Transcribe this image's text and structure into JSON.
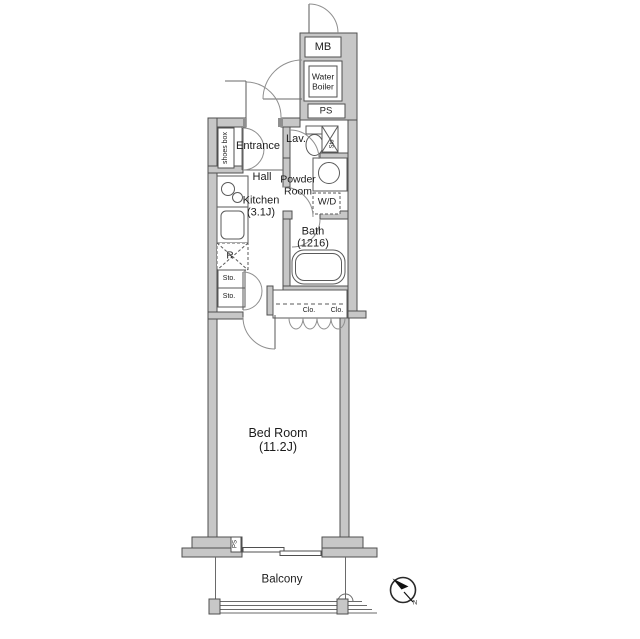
{
  "plan": {
    "title": "apartment-floorplan",
    "labels": {
      "mb": "MB",
      "water_boiler": "Water Boiler",
      "ps_top": "PS",
      "shoes_box": "shoes box",
      "entrance": "Entrance",
      "lav": "Lav.",
      "sto_small": "Sto",
      "hall": "Hall",
      "powder_room": "Powder Room",
      "wd": "W/D",
      "kitchen": "Kitchen (3.1J)",
      "bath": "Bath (1216)",
      "fridge": "R",
      "sto_1": "Sto.",
      "sto_2": "Sto.",
      "clo_1": "Clo.",
      "clo_2": "Clo.",
      "bedroom": "Bed Room (11.2J)",
      "ps_bottom": "PS",
      "balcony": "Balcony",
      "compass_n": "N"
    },
    "colors": {
      "wall": "#c7c7c7",
      "line": "#4f4f4f",
      "arc": "#8f8f8f",
      "text": "#1c1c1c"
    }
  }
}
